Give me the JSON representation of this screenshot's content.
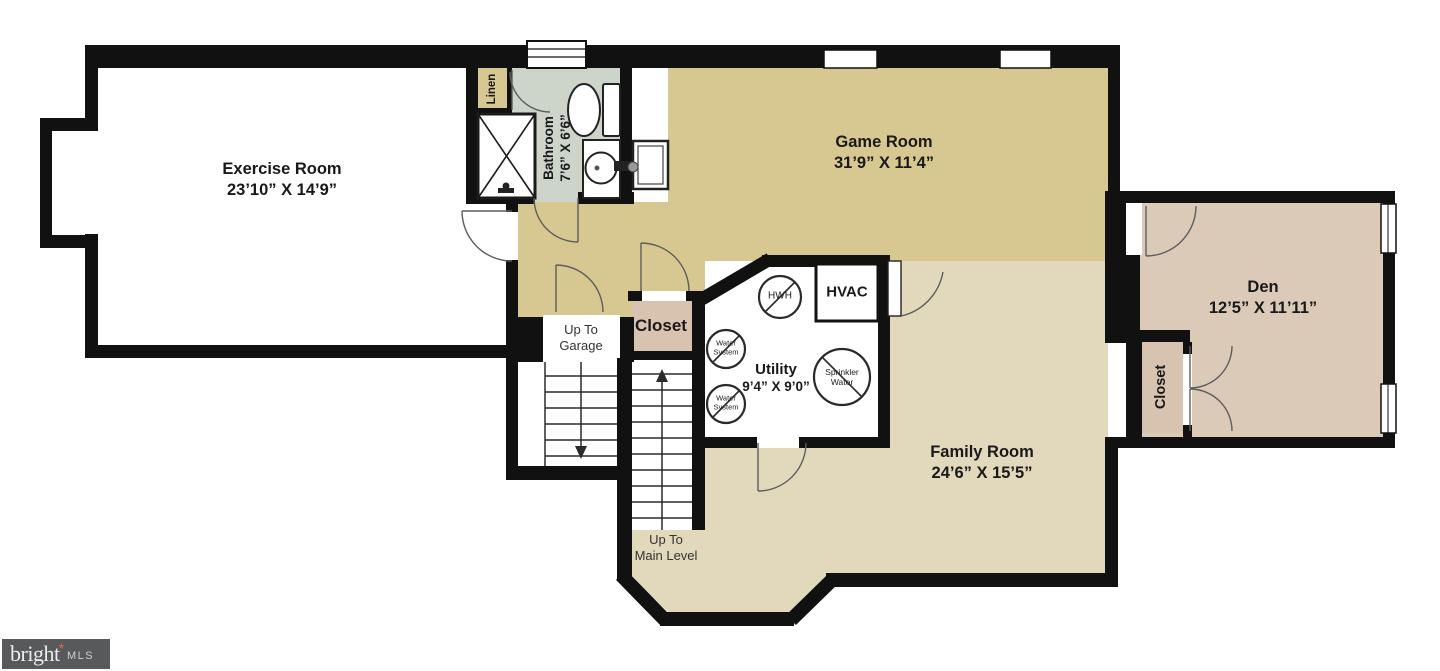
{
  "rooms": {
    "exercise": {
      "name": "Exercise Room",
      "dims": "23’10” X 14’9”"
    },
    "bathroom": {
      "name": "Bathroom",
      "dims": "7’6” X 6’6”"
    },
    "game": {
      "name": "Game Room",
      "dims": "31’9” X 11’4”"
    },
    "den": {
      "name": "Den",
      "dims": "12’5” X 11’11”"
    },
    "utility": {
      "name": "Utility",
      "dims": "9’4” X 9’0”"
    },
    "family": {
      "name": "Family Room",
      "dims": "24’6” X 15’5”"
    },
    "linen": {
      "label": "Linen"
    },
    "closet_hall": {
      "label": "Closet"
    },
    "closet_den": {
      "label": "Closet"
    }
  },
  "stairs": {
    "garage": {
      "line1": "Up To",
      "line2": "Garage"
    },
    "main": {
      "line1": "Up To",
      "line2": "Main Level"
    }
  },
  "equipment": {
    "hwh": "HWH",
    "hvac": "HVAC",
    "water_system_line1": "Water",
    "water_system_line2": "System",
    "sprinkler_line1": "Sprinkler",
    "sprinkler_line2": "Water"
  },
  "logo": {
    "brand": "bright",
    "mark": "*",
    "suffix": "MLS"
  },
  "colors": {
    "wall": "#111111",
    "game_room_floor": "#d6c890",
    "family_room_floor": "#e2d8bc",
    "den_floor": "#dccab8",
    "closet_floor": "#d8c2b0",
    "bathroom_floor": "#cdd4c9",
    "linen_floor": "#d6c890",
    "logo_bg": "#58595b",
    "logo_accent": "#e8684a"
  }
}
